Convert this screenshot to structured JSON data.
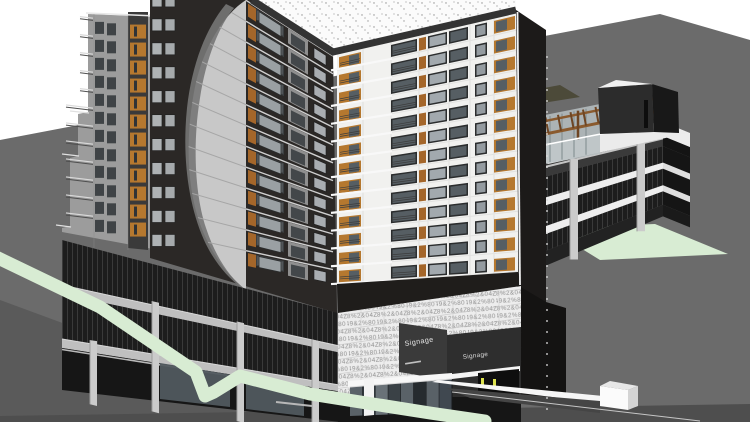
{
  "labels": {
    "signage_primary": "Signage",
    "signage_secondary": "Signage"
  },
  "pattern_glyphs": {
    "row1": "8%2&04Z6",
    "row2": "Z49&2%80"
  },
  "counts": {
    "tower_floors": 13,
    "left_face_floors": 13,
    "wing_floors": 12,
    "podium_levels": 3,
    "garage_screen_bands": 3
  },
  "colors": {
    "sky": "#ffffff",
    "ground": "#6b6b6b",
    "ground_shade": "#5a5a5a",
    "ground_strip": "#4e4e4e",
    "lawn": "#d8ecd3",
    "wing_face": "#9c9c9c",
    "wing_strip": "#3a3a3a",
    "orange": "#a4662a",
    "orange_bright": "#b5782f",
    "tower_dark": "#2b2826",
    "tower_side": "#1c1a19",
    "podium_side": "#141312",
    "white_face": "#f1f1ef",
    "face_line": "#e2e2e0",
    "grid_line": "#dcdcda",
    "glass": "#949ba0",
    "glass_mid": "#a2a9ae",
    "glass_dark": "#565e63",
    "frame": "#2b2d2e",
    "lens_light": "#c8c8c8",
    "lens_dark": "#757575",
    "lens_line": "#a6a6a6",
    "roof": "#fbfbfb",
    "roof_dot": "#909090",
    "parapet": "#333333",
    "slab": "#efefef",
    "screen": "#1d1d1d",
    "screen_line": "#3a3a3a",
    "column": "#cbcbcb",
    "ceiling": "#c4c4c4",
    "interior": "#3a3a3a",
    "pergola": "#8a5a2e",
    "pergola_dark": "#6e4523",
    "core_front": "#2c2c2c",
    "core_side": "#181818",
    "core_top": "#f1f1f1",
    "terrace_deck": "#ebebeb",
    "terrace_glass": "#b7c0c2",
    "roof_garden": "#4c4a39",
    "pattern_bg": "#ededed",
    "pattern_glyph": "#8e8e8e",
    "pattern_joint": "#c6c6c6",
    "signage_panel": "#3a3a3a",
    "signage_panel2": "#2e2e2e",
    "signage_text": "#e4e4e4",
    "canopy": "#f7f7f7",
    "storefront": "#5a6268",
    "storefront_dark": "#31373c",
    "mullion": "#17191b",
    "soffit": "#1f1d1b",
    "bollard": "#dde24e",
    "dot_line": "#d9d9d9",
    "ramp_white": "#f6f6f6",
    "ramp_dark": "#454545",
    "podium_screen": "#262626",
    "podium_slab": "#bfbfbf",
    "entrance_glass": "#50585e",
    "rail_dark": "#3b3f41",
    "rail_tick": "#73777a"
  }
}
